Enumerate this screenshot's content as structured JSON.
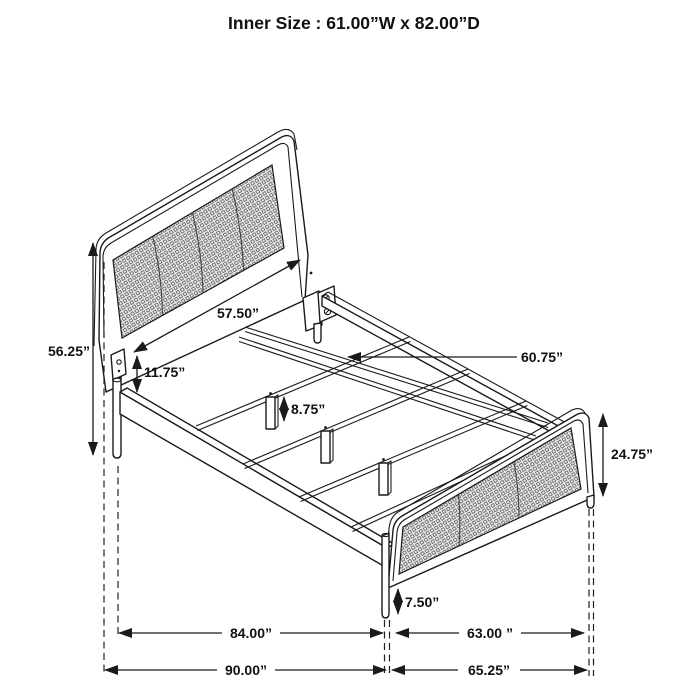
{
  "title": "Inner Size : 61.00”W x 82.00”D",
  "dimensions": {
    "headboard_width": "57.50”",
    "headboard_height": "56.25”",
    "headboard_rail_height": "11.75”",
    "slat_length": "60.75”",
    "center_support_leg_height": "8.75”",
    "footboard_height": "24.75”",
    "footboard_leg_height": "7.50”",
    "slat_frame_length": "84.00”",
    "footboard_span": "63.00 ”",
    "overall_length": "90.00”",
    "overall_footboard_span": "65.25”"
  },
  "colors": {
    "line": "#1a1a1a",
    "mesh_fill": "#ededed",
    "mesh_grid": "#4a4a4a",
    "background": "#ffffff"
  }
}
